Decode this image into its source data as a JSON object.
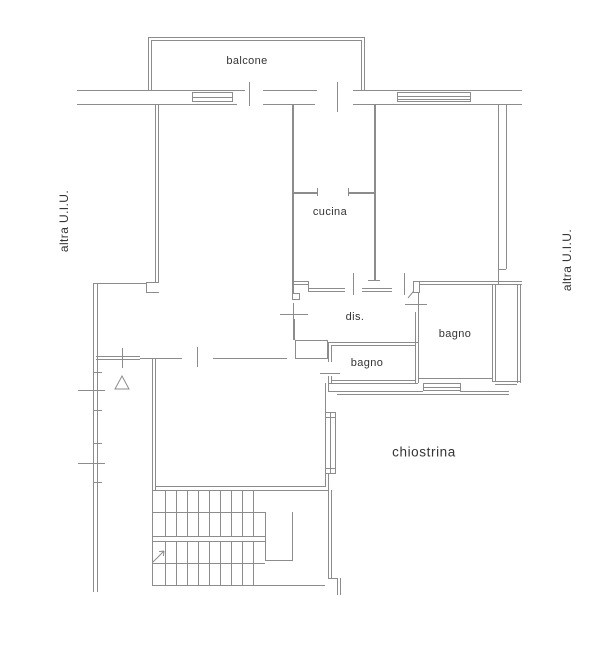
{
  "drawing": {
    "kind": "floor plan",
    "labels": {
      "balcone": "balcone",
      "cucina": "cucina",
      "dis": "dis.",
      "bagno_right": "bagno",
      "bagno_lower": "bagno",
      "chiostrina": "chiostrina",
      "altra_uiu_left": "altra U.I.U.",
      "altra_uiu_right": "altra U.I.U."
    },
    "colors": {
      "background": "#ffffff",
      "line": "#8c8c8c",
      "text": "#343434"
    }
  }
}
